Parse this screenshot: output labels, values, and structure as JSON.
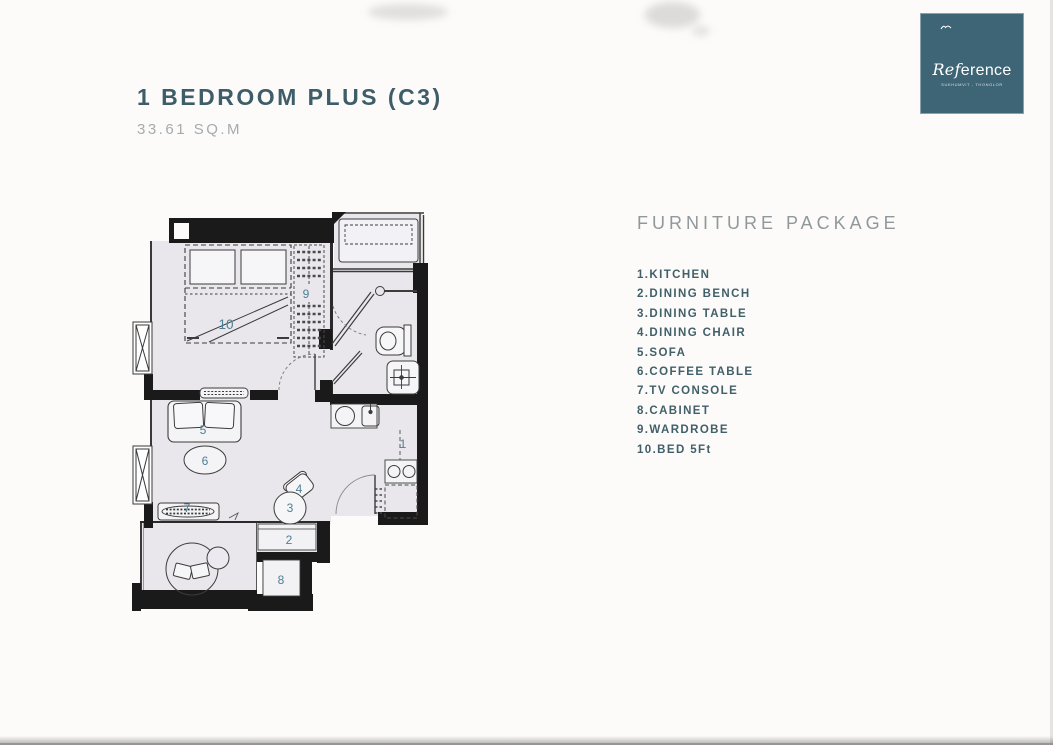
{
  "page": {
    "title": "1 BEDROOM PLUS (C3)",
    "area": "33.61 SQ.M"
  },
  "logo": {
    "brand_ref": "Ref",
    "brand_rest": "erence",
    "tagline": "SUKHUMVIT - THONGLOR",
    "bg_color": "#3d6576"
  },
  "furniture_package": {
    "heading": "FURNITURE PACKAGE",
    "items": [
      "1.KITCHEN",
      "2.DINING BENCH",
      "3.DINING TABLE",
      "4.DINING CHAIR",
      "5.SOFA",
      "6.COFFEE TABLE",
      "7.TV CONSOLE",
      "8.CABINET",
      "9.WARDROBE",
      "10.BED 5Ft"
    ]
  },
  "plan": {
    "labels": [
      "1",
      "2",
      "3",
      "4",
      "5",
      "6",
      "7",
      "8",
      "9",
      "10"
    ]
  },
  "colors": {
    "title": "#3f5d68",
    "subtitle": "#a4abaf",
    "heading": "#90989c",
    "list_text": "#41606a",
    "plan_number": "#4e8095",
    "wall": "#1a1a1a",
    "floor": "#e9e7ec",
    "logo_bg": "#3d6576"
  }
}
